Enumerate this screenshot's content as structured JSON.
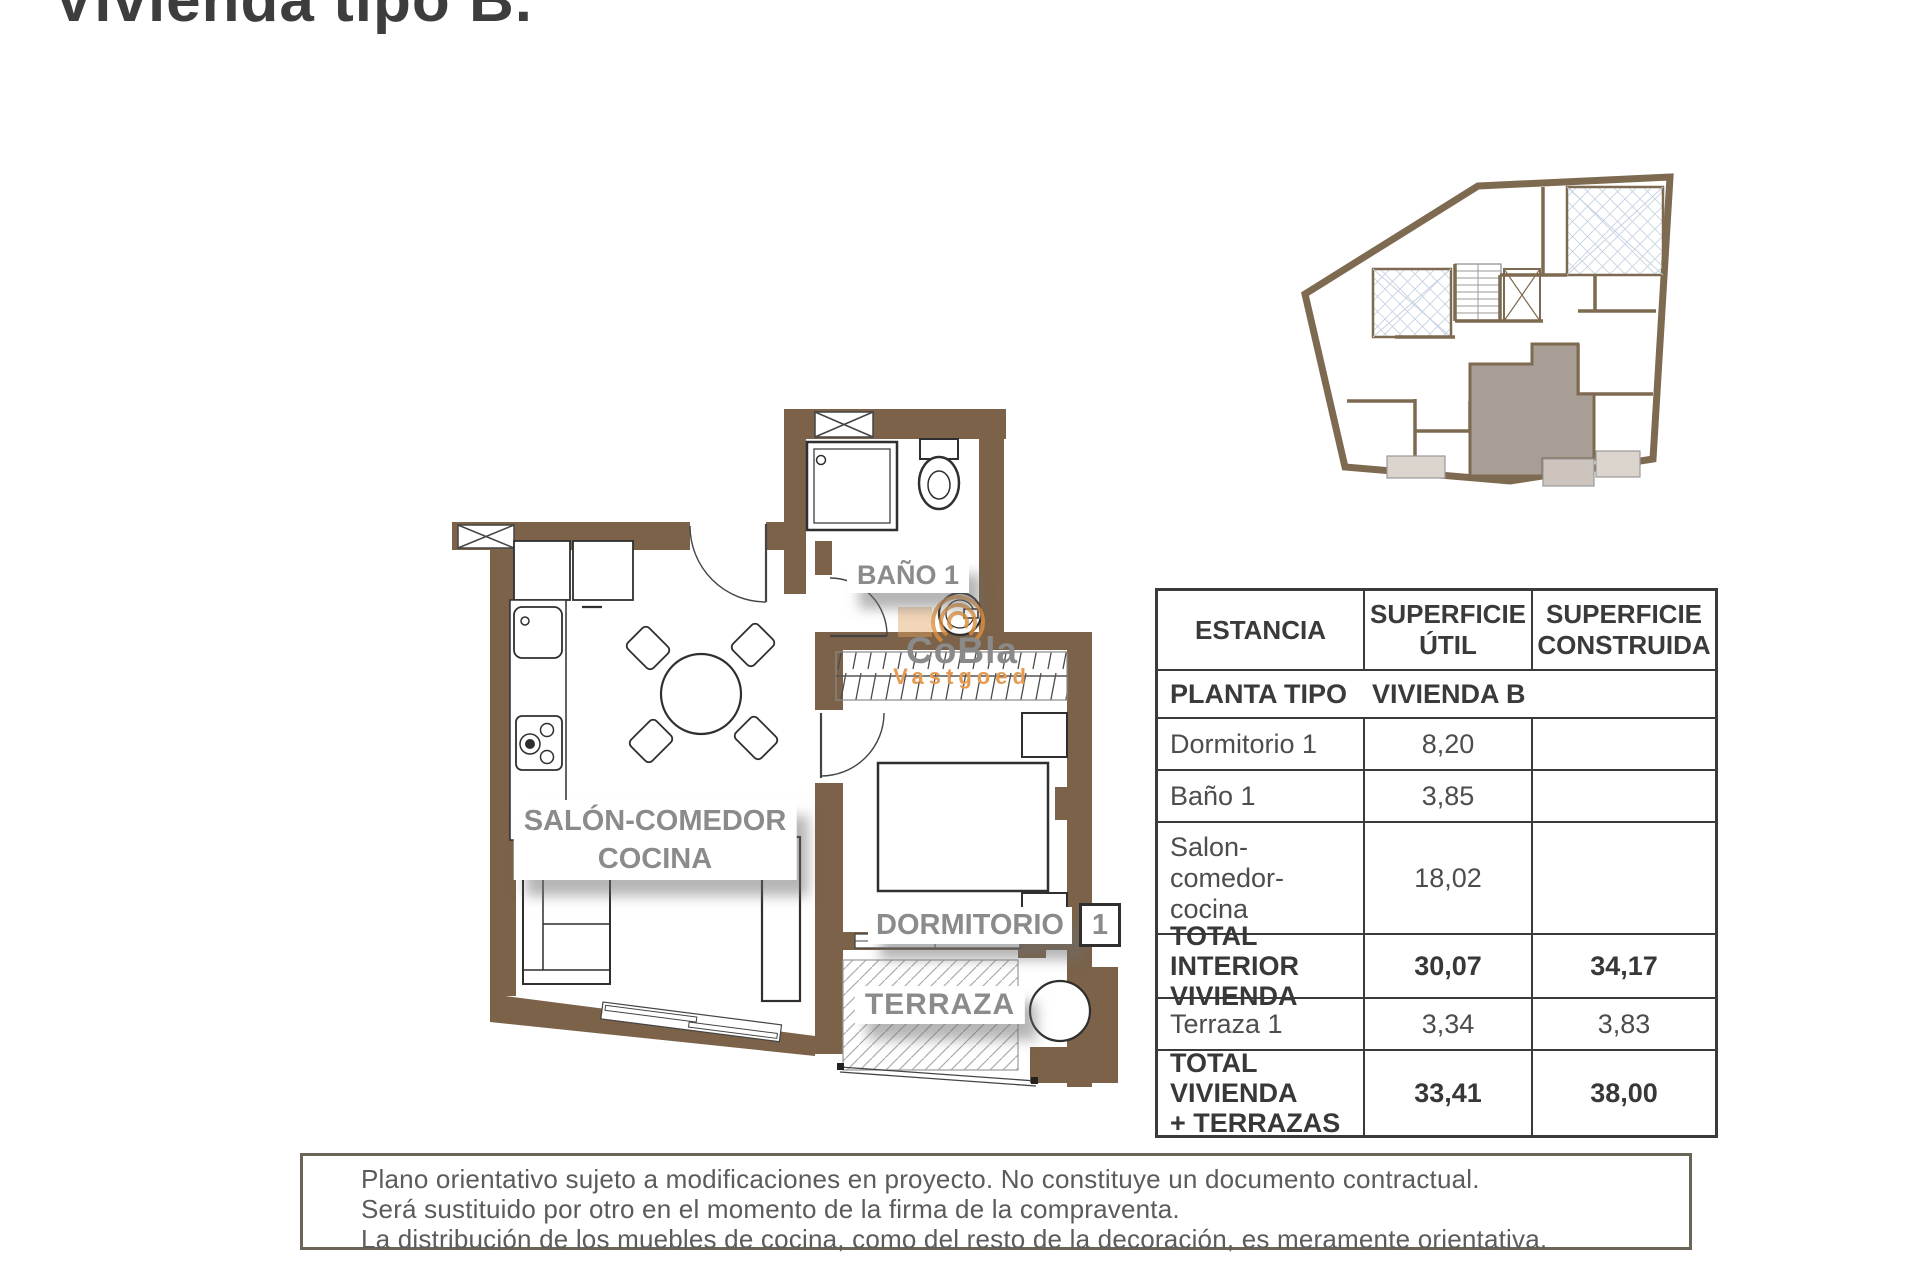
{
  "title": "Vivienda tipo B.",
  "watermark": {
    "brand": "CoBla",
    "subtitle": "Vastgoed"
  },
  "floorplan": {
    "labels": {
      "bathroom": "BAÑO 1",
      "living_line1": "SALÓN-COMEDOR",
      "living_line2": "COCINA",
      "bedroom": "DORMITORIO",
      "bedroom_number": "1",
      "terrace": "TERRAZA"
    }
  },
  "table": {
    "headers": {
      "estancia": "ESTANCIA",
      "util": "SUPERFICIE\nÚTIL",
      "construida": "SUPERFICIE\nCONSTRUIDA"
    },
    "subheader": {
      "left": "PLANTA TIPO",
      "right": "VIVIENDA B"
    },
    "rows": [
      {
        "estancia": "Dormitorio 1",
        "util": "8,20",
        "construida": ""
      },
      {
        "estancia": "Baño 1",
        "util": "3,85",
        "construida": ""
      },
      {
        "estancia": "Salon-\ncomedor-\ncocina",
        "util": "18,02",
        "construida": ""
      },
      {
        "estancia": "TOTAL INTERIOR\nVIVIENDA",
        "util": "30,07",
        "construida": "34,17"
      },
      {
        "estancia": "Terraza 1",
        "util": "3,34",
        "construida": "3,83"
      },
      {
        "estancia": "TOTAL VIVIENDA\n+ TERRAZAS",
        "util": "33,41",
        "construida": "38,00"
      }
    ]
  },
  "disclaimer": {
    "line1": "Plano orientativo sujeto a modificaciones en proyecto. No constituye un documento contractual.",
    "line2": "Será sustituido por otro en el momento de la firma de la compraventa.",
    "line3": "La distribución de los muebles de cocina, como del resto de la decoración, es meramente orientativa."
  },
  "colors": {
    "wall_brown": "#7b6249",
    "unit_highlight": "#a99e96",
    "accent_orange": "#e59a50",
    "label_gray": "#8b8b8b"
  }
}
